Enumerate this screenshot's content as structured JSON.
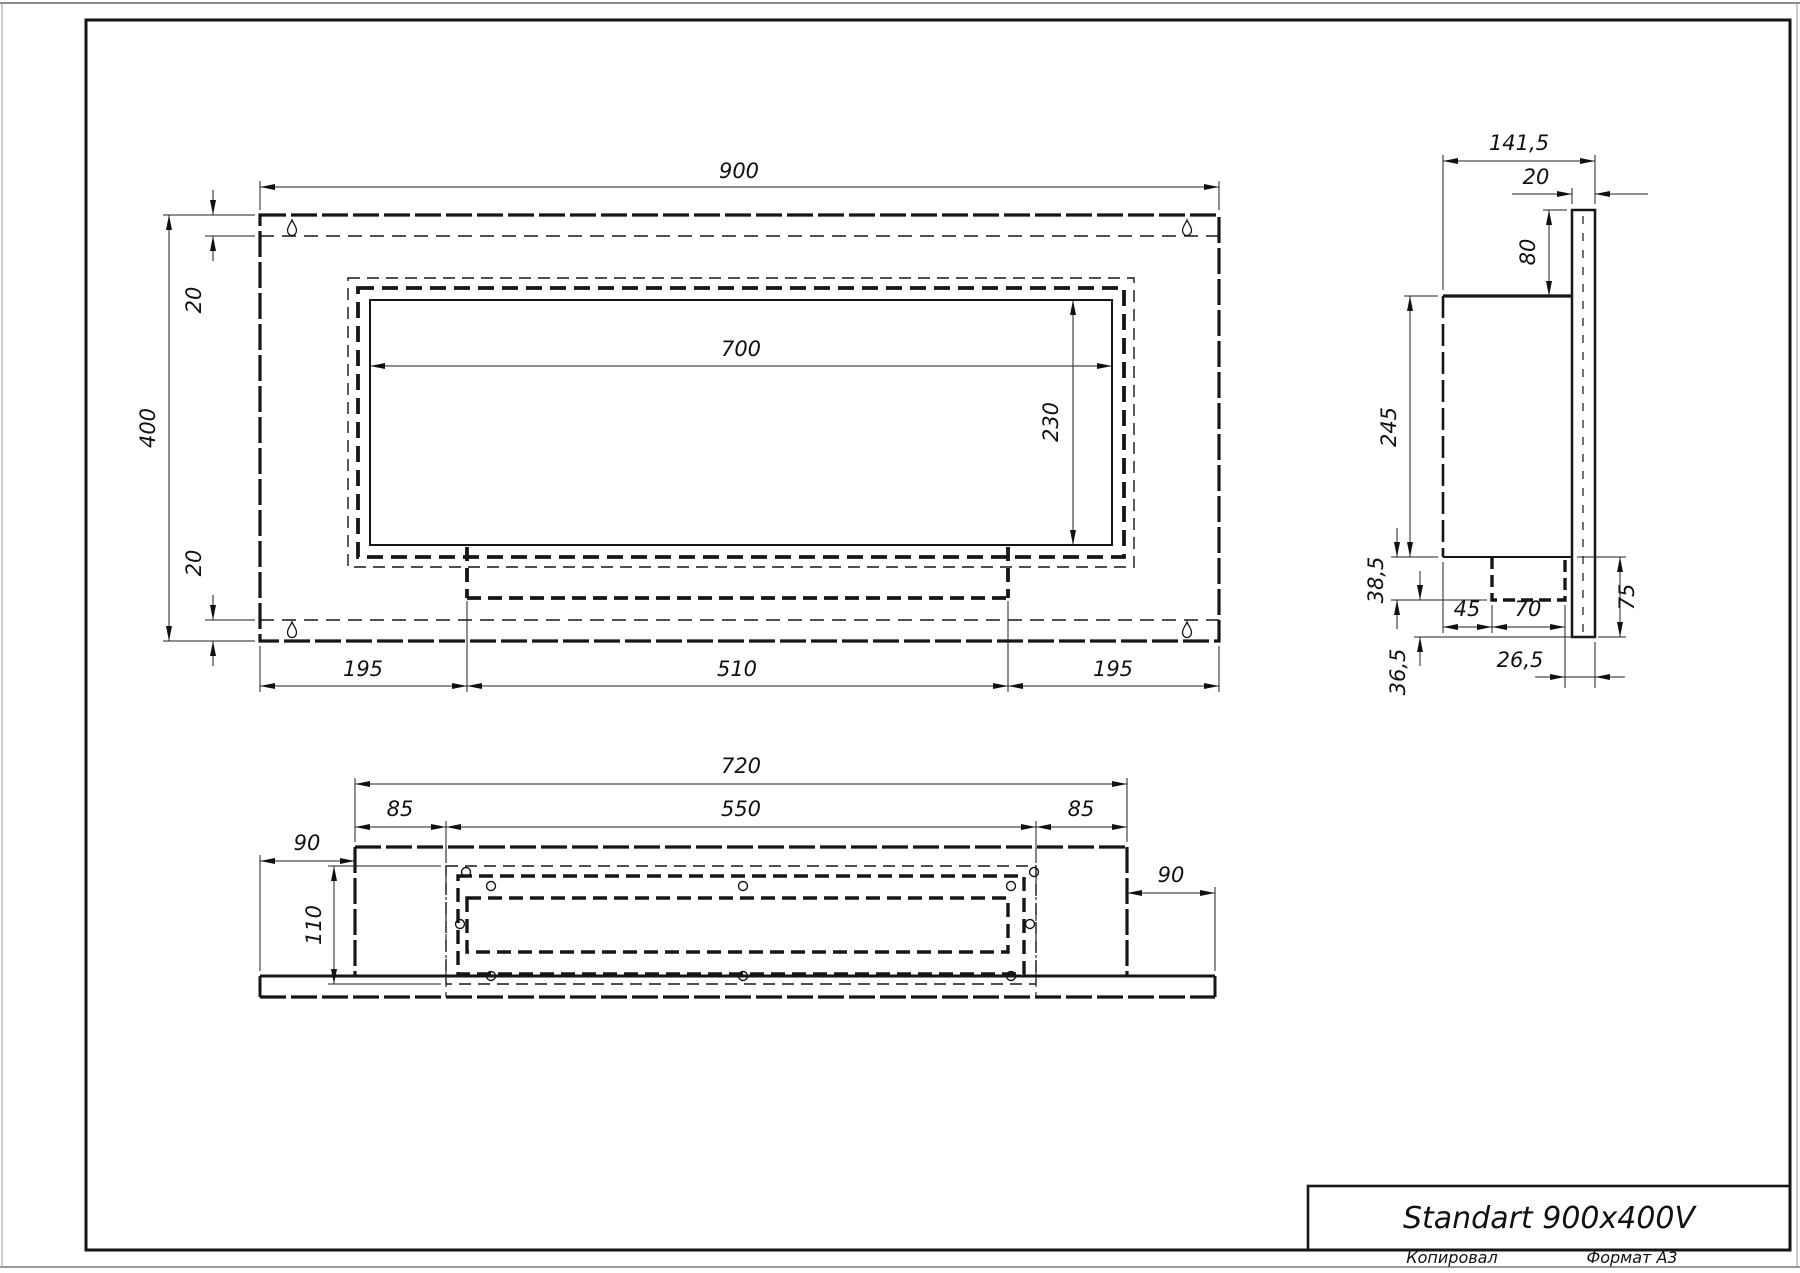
{
  "title_block": {
    "title": "Standart 900x400V"
  },
  "sheet": {
    "copied_label": "Копировал",
    "format_label": "Формат А3"
  },
  "dims": {
    "front_width": "900",
    "front_height": "400",
    "front_top_inset": "20",
    "front_bottom_inset": "20",
    "opening_width": "700",
    "opening_height": "230",
    "front_left": "195",
    "front_center": "510",
    "front_right": "195",
    "side_depth": "141,5",
    "side_plate": "20",
    "side_top": "80",
    "side_body": "245",
    "side_burner_drop": "38,5",
    "side_front_gap": "45",
    "side_burner_depth": "70",
    "side_below": "75",
    "side_rear": "26,5",
    "side_lower": "36,5",
    "bottom_width": "720",
    "bottom_left": "85",
    "bottom_opening": "550",
    "bottom_right": "85",
    "bottom_flange_left": "90",
    "bottom_depth": "110",
    "bottom_flange_right": "90"
  }
}
